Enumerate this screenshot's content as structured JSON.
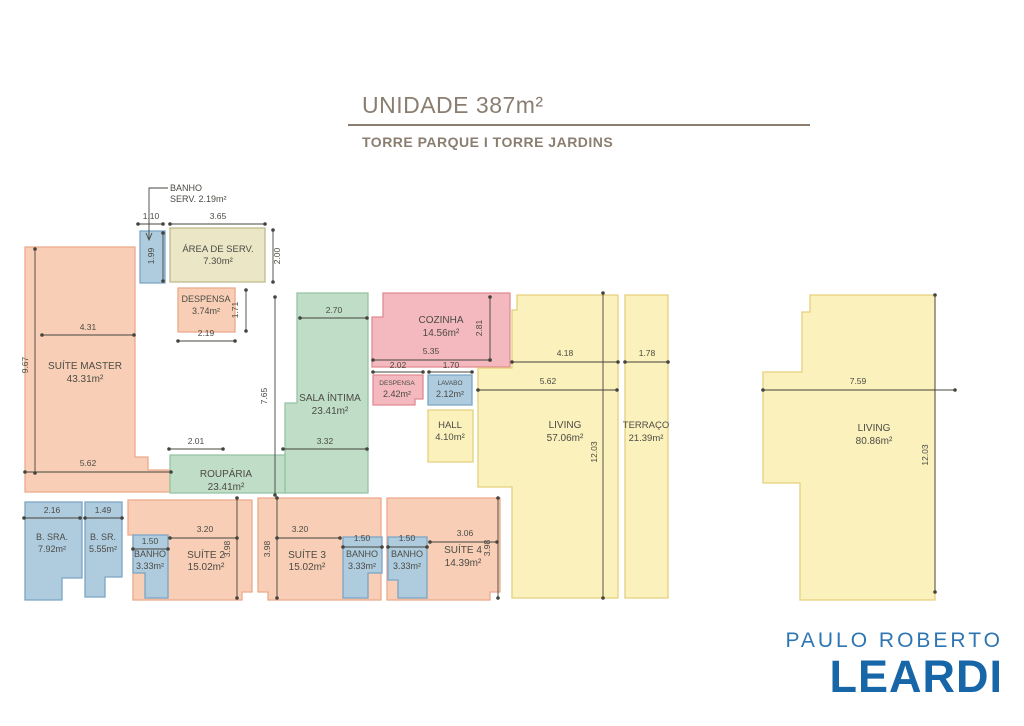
{
  "header": {
    "title": "UNIDADE 387m²",
    "subtitle": "TORRE PARQUE I TORRE JARDINS"
  },
  "logo": {
    "line1": "PAULO ROBERTO",
    "line2": "LEARDI"
  },
  "plan": {
    "palette": {
      "salmon": {
        "fill": "#f8cfb6",
        "stroke": "#eba98a"
      },
      "pink": {
        "fill": "#f4b9be",
        "stroke": "#e08a92"
      },
      "blue": {
        "fill": "#afccdf",
        "stroke": "#7ba4c4"
      },
      "green": {
        "fill": "#c0ddc7",
        "stroke": "#94c4a2"
      },
      "yellow": {
        "fill": "#fbf1bc",
        "stroke": "#e5d07e"
      },
      "olive": {
        "fill": "#eae6c6",
        "stroke": "#bdb98b"
      }
    },
    "ink": {
      "line": "#44443e",
      "dim": "#4a4a44",
      "label": "#4b4b45"
    },
    "rooms": [
      {
        "id": "area-de-servico",
        "color": "olive",
        "points": "170,228 265,228 265,282 170,282",
        "labels": [
          {
            "text": "ÁREA DE SERV.",
            "x": 218,
            "y": 252,
            "size": 9.5
          },
          {
            "text": "7.30m²",
            "x": 218,
            "y": 264,
            "size": 9.5
          }
        ]
      },
      {
        "id": "banho-servico",
        "color": "blue",
        "points": "140,231 165,231 165,283 140,283",
        "labels": []
      },
      {
        "id": "despensa-superior",
        "color": "salmon",
        "points": "178,288 235,288 235,332 178,332",
        "labels": [
          {
            "text": "DESPENSA",
            "x": 206,
            "y": 302,
            "size": 9
          },
          {
            "text": "3.74m²",
            "x": 206,
            "y": 314,
            "size": 9
          }
        ]
      },
      {
        "id": "suite-master",
        "color": "salmon",
        "points": "25,247 135,247 135,457 148,457 148,470 170,470 170,492 25,492",
        "labels": [
          {
            "text": "SUÍTE MASTER",
            "x": 85,
            "y": 369,
            "size": 10
          },
          {
            "text": "43.31m²",
            "x": 85,
            "y": 382,
            "size": 10
          }
        ]
      },
      {
        "id": "sala-intima",
        "color": "green",
        "points": "297,293 368,293 368,493 285,493 285,403 297,403",
        "labels": [
          {
            "text": "SALA ÍNTIMA",
            "x": 330,
            "y": 401,
            "size": 10
          },
          {
            "text": "23.41m²",
            "x": 330,
            "y": 414,
            "size": 10
          }
        ]
      },
      {
        "id": "rouparia",
        "color": "green",
        "points": "170,455 285,455 285,493 170,493",
        "labels": [
          {
            "text": "ROUPÁRIA",
            "x": 226,
            "y": 477,
            "size": 10
          },
          {
            "text": "23.41m²",
            "x": 226,
            "y": 490,
            "size": 10
          }
        ]
      },
      {
        "id": "cozinha",
        "color": "pink",
        "points": "383,293 510,293 510,367 372,367 372,317 383,317",
        "labels": [
          {
            "text": "COZINHA",
            "x": 441,
            "y": 323,
            "size": 10
          },
          {
            "text": "14.56m²",
            "x": 441,
            "y": 336,
            "size": 10
          }
        ]
      },
      {
        "id": "despensa-inferior",
        "color": "pink",
        "points": "373,375 423,375 423,399 415,399 415,405 373,405",
        "labels": [
          {
            "text": "DESPENSA",
            "x": 397,
            "y": 385,
            "size": 6.5
          },
          {
            "text": "2.42m²",
            "x": 397,
            "y": 397,
            "size": 9
          }
        ]
      },
      {
        "id": "lavabo",
        "color": "blue",
        "points": "428,375 472,375 472,405 428,405",
        "labels": [
          {
            "text": "LAVABO",
            "x": 450,
            "y": 385,
            "size": 6.5
          },
          {
            "text": "2.12m²",
            "x": 450,
            "y": 397,
            "size": 9
          }
        ]
      },
      {
        "id": "hall",
        "color": "yellow",
        "points": "428,410 473,410 473,462 428,462",
        "labels": [
          {
            "text": "HALL",
            "x": 450,
            "y": 428,
            "size": 9.5
          },
          {
            "text": "4.10m²",
            "x": 450,
            "y": 440,
            "size": 9.5
          }
        ]
      },
      {
        "id": "living-esquerdo",
        "color": "yellow",
        "points": "517,295 618,295 618,598 512,598 512,487 478,487 478,368 512,368 512,310 517,310",
        "labels": [
          {
            "text": "LIVING",
            "x": 565,
            "y": 428,
            "size": 10
          },
          {
            "text": "57.06m²",
            "x": 565,
            "y": 441,
            "size": 10
          }
        ]
      },
      {
        "id": "terraco",
        "color": "yellow",
        "points": "625,295 668,295 668,598 625,598",
        "labels": [
          {
            "text": "TERRAÇO",
            "x": 646,
            "y": 428,
            "size": 9.5
          },
          {
            "text": "21.39m²",
            "x": 646,
            "y": 441,
            "size": 9.5
          }
        ]
      },
      {
        "id": "suite-2",
        "color": "salmon",
        "points": "128,500 252,500 252,592 242,592 242,600 133,600 133,535 128,535",
        "labels": [
          {
            "text": "SUÍTE 2",
            "x": 206,
            "y": 558,
            "size": 10
          },
          {
            "text": "15.02m²",
            "x": 206,
            "y": 570,
            "size": 10
          }
        ]
      },
      {
        "id": "banho-suite-2",
        "color": "blue",
        "points": "133,535 168,535 168,598 145,598 145,573 133,573",
        "labels": [
          {
            "text": "BANHO",
            "x": 150,
            "y": 557,
            "size": 9
          },
          {
            "text": "3.33m²",
            "x": 150,
            "y": 569,
            "size": 9
          }
        ]
      },
      {
        "id": "suite-3",
        "color": "salmon",
        "points": "258,498 381,498 381,600 268,600 268,592 258,592",
        "labels": [
          {
            "text": "SUÍTE 3",
            "x": 307,
            "y": 558,
            "size": 10
          },
          {
            "text": "15.02m²",
            "x": 307,
            "y": 570,
            "size": 10
          }
        ]
      },
      {
        "id": "banho-suite-3",
        "color": "blue",
        "points": "343,537 382,537 382,573 368,573 368,598 343,598",
        "labels": [
          {
            "text": "BANHO",
            "x": 362,
            "y": 557,
            "size": 9
          },
          {
            "text": "3.33m²",
            "x": 362,
            "y": 569,
            "size": 9
          }
        ]
      },
      {
        "id": "suite-4",
        "color": "salmon",
        "points": "387,498 500,498 500,592 490,592 490,600 387,600",
        "labels": [
          {
            "text": "SUÍTE 4",
            "x": 463,
            "y": 553,
            "size": 10
          },
          {
            "text": "14.39m²",
            "x": 463,
            "y": 566,
            "size": 10
          }
        ]
      },
      {
        "id": "banho-suite-4",
        "color": "blue",
        "points": "388,537 427,537 427,598 398,598 398,580 388,580",
        "labels": [
          {
            "text": "BANHO",
            "x": 407,
            "y": 557,
            "size": 9
          },
          {
            "text": "3.33m²",
            "x": 407,
            "y": 569,
            "size": 9
          }
        ]
      },
      {
        "id": "banho-sra",
        "color": "blue",
        "points": "25,502 82,502 82,578 62,578 62,600 25,600",
        "labels": [
          {
            "text": "B. SRA.",
            "x": 52,
            "y": 540,
            "size": 9
          },
          {
            "text": "7.92m²",
            "x": 52,
            "y": 552,
            "size": 9
          }
        ]
      },
      {
        "id": "banho-sr",
        "color": "blue",
        "points": "85,502 122,502 122,577 105,577 105,597 85,597",
        "labels": [
          {
            "text": "B. SR.",
            "x": 103,
            "y": 540,
            "size": 9
          },
          {
            "text": "5.55m²",
            "x": 103,
            "y": 552,
            "size": 9
          }
        ]
      },
      {
        "id": "living-direito",
        "color": "yellow",
        "points": "810,295 935,295 935,600 800,600 800,483 763,483 763,372 802,372 802,312 810,312",
        "labels": [
          {
            "text": "LIVING",
            "x": 874,
            "y": 431,
            "size": 10
          },
          {
            "text": "80.86m²",
            "x": 874,
            "y": 444,
            "size": 10
          }
        ]
      }
    ],
    "dims": [
      {
        "text": "1.10",
        "x1": 138,
        "y1": 224,
        "x2": 163,
        "y2": 224,
        "tx": 151,
        "ty": 219
      },
      {
        "text": "3.65",
        "x1": 170,
        "y1": 224,
        "x2": 265,
        "y2": 224,
        "tx": 218,
        "ty": 219
      },
      {
        "text": "2.00",
        "x1": 273,
        "y1": 230,
        "x2": 273,
        "y2": 282,
        "tx": 280,
        "ty": 256,
        "rot": true
      },
      {
        "text": "1.99",
        "x1": 163,
        "y1": 233,
        "x2": 163,
        "y2": 281,
        "tx": 154,
        "ty": 256,
        "rot": true
      },
      {
        "text": "1.71",
        "x1": 246,
        "y1": 290,
        "x2": 246,
        "y2": 331,
        "tx": 238,
        "ty": 310,
        "rot": true
      },
      {
        "text": "2.19",
        "x1": 178,
        "y1": 341,
        "x2": 235,
        "y2": 341,
        "tx": 206,
        "ty": 336
      },
      {
        "text": "4.31",
        "x1": 42,
        "y1": 335,
        "x2": 134,
        "y2": 335,
        "tx": 88,
        "ty": 330
      },
      {
        "text": "9.67",
        "x1": 35,
        "y1": 249,
        "x2": 35,
        "y2": 473,
        "tx": 28,
        "ty": 365,
        "rot": true
      },
      {
        "text": "5.62",
        "x1": 25,
        "y1": 472,
        "x2": 171,
        "y2": 472,
        "tx": 88,
        "ty": 466
      },
      {
        "text": "2.70",
        "x1": 300,
        "y1": 318,
        "x2": 367,
        "y2": 318,
        "tx": 334,
        "ty": 313
      },
      {
        "text": "7.65",
        "x1": 275,
        "y1": 297,
        "x2": 275,
        "y2": 495,
        "tx": 267,
        "ty": 396,
        "rot": true
      },
      {
        "text": "3.32",
        "x1": 283,
        "y1": 449,
        "x2": 367,
        "y2": 449,
        "tx": 325,
        "ty": 444
      },
      {
        "text": "2.01",
        "x1": 169,
        "y1": 449,
        "x2": 223,
        "y2": 449,
        "tx": 196,
        "ty": 444
      },
      {
        "text": "2.81",
        "x1": 490,
        "y1": 297,
        "x2": 490,
        "y2": 360,
        "tx": 482,
        "ty": 328,
        "rot": true
      },
      {
        "text": "5.35",
        "x1": 373,
        "y1": 360,
        "x2": 490,
        "y2": 360,
        "tx": 431,
        "ty": 354
      },
      {
        "text": "2.02",
        "x1": 373,
        "y1": 372,
        "x2": 423,
        "y2": 372,
        "tx": 398,
        "ty": 368
      },
      {
        "text": "1.70",
        "x1": 429,
        "y1": 372,
        "x2": 472,
        "y2": 372,
        "tx": 451,
        "ty": 368
      },
      {
        "text": "4.18",
        "x1": 512,
        "y1": 362,
        "x2": 618,
        "y2": 362,
        "tx": 565,
        "ty": 356
      },
      {
        "text": "1.78",
        "x1": 625,
        "y1": 362,
        "x2": 668,
        "y2": 362,
        "tx": 647,
        "ty": 356
      },
      {
        "text": "5.62",
        "x1": 478,
        "y1": 390,
        "x2": 617,
        "y2": 390,
        "tx": 548,
        "ty": 384
      },
      {
        "text": "12.03",
        "x1": 603,
        "y1": 293,
        "x2": 603,
        "y2": 598,
        "tx": 597,
        "ty": 452,
        "rot": true
      },
      {
        "text": "2.16",
        "x1": 24,
        "y1": 518,
        "x2": 80,
        "y2": 518,
        "tx": 52,
        "ty": 513
      },
      {
        "text": "1.49",
        "x1": 85,
        "y1": 518,
        "x2": 122,
        "y2": 518,
        "tx": 103,
        "ty": 513
      },
      {
        "text": "1.50",
        "x1": 133,
        "y1": 549,
        "x2": 168,
        "y2": 549,
        "tx": 150,
        "ty": 544
      },
      {
        "text": "3.20",
        "x1": 170,
        "y1": 538,
        "x2": 237,
        "y2": 538,
        "tx": 205,
        "ty": 532
      },
      {
        "text": "3.98",
        "x1": 237,
        "y1": 498,
        "x2": 237,
        "y2": 598,
        "tx": 230,
        "ty": 549,
        "rot": true
      },
      {
        "text": "3.98",
        "x1": 277,
        "y1": 498,
        "x2": 277,
        "y2": 598,
        "tx": 270,
        "ty": 549,
        "rot": true
      },
      {
        "text": "3.20",
        "x1": 277,
        "y1": 538,
        "x2": 340,
        "y2": 538,
        "tx": 300,
        "ty": 532
      },
      {
        "text": "1.50",
        "x1": 343,
        "y1": 547,
        "x2": 382,
        "y2": 547,
        "tx": 362,
        "ty": 541
      },
      {
        "text": "1.50",
        "x1": 388,
        "y1": 547,
        "x2": 427,
        "y2": 547,
        "tx": 407,
        "ty": 541
      },
      {
        "text": "3.06",
        "x1": 430,
        "y1": 542,
        "x2": 497,
        "y2": 542,
        "tx": 465,
        "ty": 536
      },
      {
        "text": "3.98",
        "x1": 498,
        "y1": 498,
        "x2": 498,
        "y2": 598,
        "tx": 490,
        "ty": 548,
        "rot": true
      },
      {
        "text": "7.59",
        "x1": 763,
        "y1": 390,
        "x2": 955,
        "y2": 390,
        "tx": 858,
        "ty": 384
      },
      {
        "text": "12.03",
        "x1": 935,
        "y1": 295,
        "x2": 935,
        "y2": 592,
        "tx": 928,
        "ty": 455,
        "rot": true
      }
    ],
    "leader": {
      "line1": "BANHO",
      "line2": "SERV.  2.19m²",
      "text_x": 170,
      "text_y1": 191,
      "text_y2": 202,
      "polyline": "168,188 149,188 149,240",
      "arrow": "146,233 149,240 152,233"
    }
  }
}
